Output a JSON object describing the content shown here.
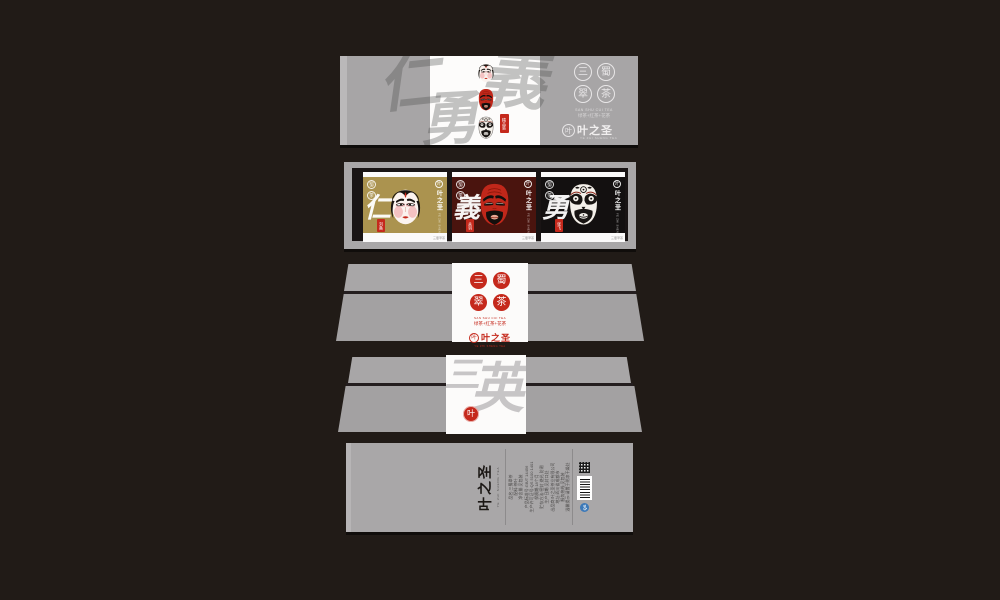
{
  "colors": {
    "background": "#211b17",
    "panel_gray": "#a8a6a7",
    "accent_red": "#c5291c",
    "card_gold": "#ab934f",
    "card_maroon": "#4a140e",
    "card_black": "#131010",
    "window_inner_black": "#191414",
    "qs_blue": "#3d79b8"
  },
  "brand": {
    "seal_chars": [
      "三",
      "蜀",
      "翠",
      "茶"
    ],
    "name_latin": "SAN SHU CUI TEA",
    "tagline": "绿茶+红茶+花茶",
    "logo_name": "叶之圣",
    "logo_sub": "YE ZHI SHENG TEA",
    "logo_glyph": "叶"
  },
  "top_panel": {
    "watermark_chars": [
      "仁",
      "義",
      "勇"
    ],
    "gift_tag": "精品装",
    "masks": [
      "liu-bei-white-mask",
      "guan-yu-red-mask",
      "zhang-fei-black-mask"
    ]
  },
  "window_panel": {
    "mini_seal_chars": [
      "蜀",
      "茶"
    ],
    "cards": [
      {
        "virtue": "仁",
        "seal_name": "刘备",
        "fine_print": "三蜀翠茶"
      },
      {
        "virtue": "義",
        "seal_name": "关羽",
        "fine_print": "三蜀翠茶"
      },
      {
        "virtue": "勇",
        "seal_name": "张飞",
        "fine_print": "三蜀翠茶"
      }
    ]
  },
  "slant_panel": {
    "watermark_chars": [
      "三",
      "英"
    ],
    "seal_glyph": "叶"
  },
  "bottom_panel": {
    "logo_name": "叶之圣",
    "logo_sub": "YE ZHI SHENG TEA",
    "qs_label": "QS",
    "info_lines": [
      "品名:三蜀翠茶",
      "配料:茶叶",
      "净含量:见包装",
      "产品标准号:GB/T 14456",
      "生产许可证号:QS 5100 1401",
      "保质期:18个月",
      "贮存方法:密封 避光 防潮",
      "生产日期:见封口处",
      "出品商:叶之圣茶业有限公司",
      "地址:四川省成都市",
      "服务热线:见包装",
      "温馨提示:请置于阴凉干燥处"
    ]
  }
}
